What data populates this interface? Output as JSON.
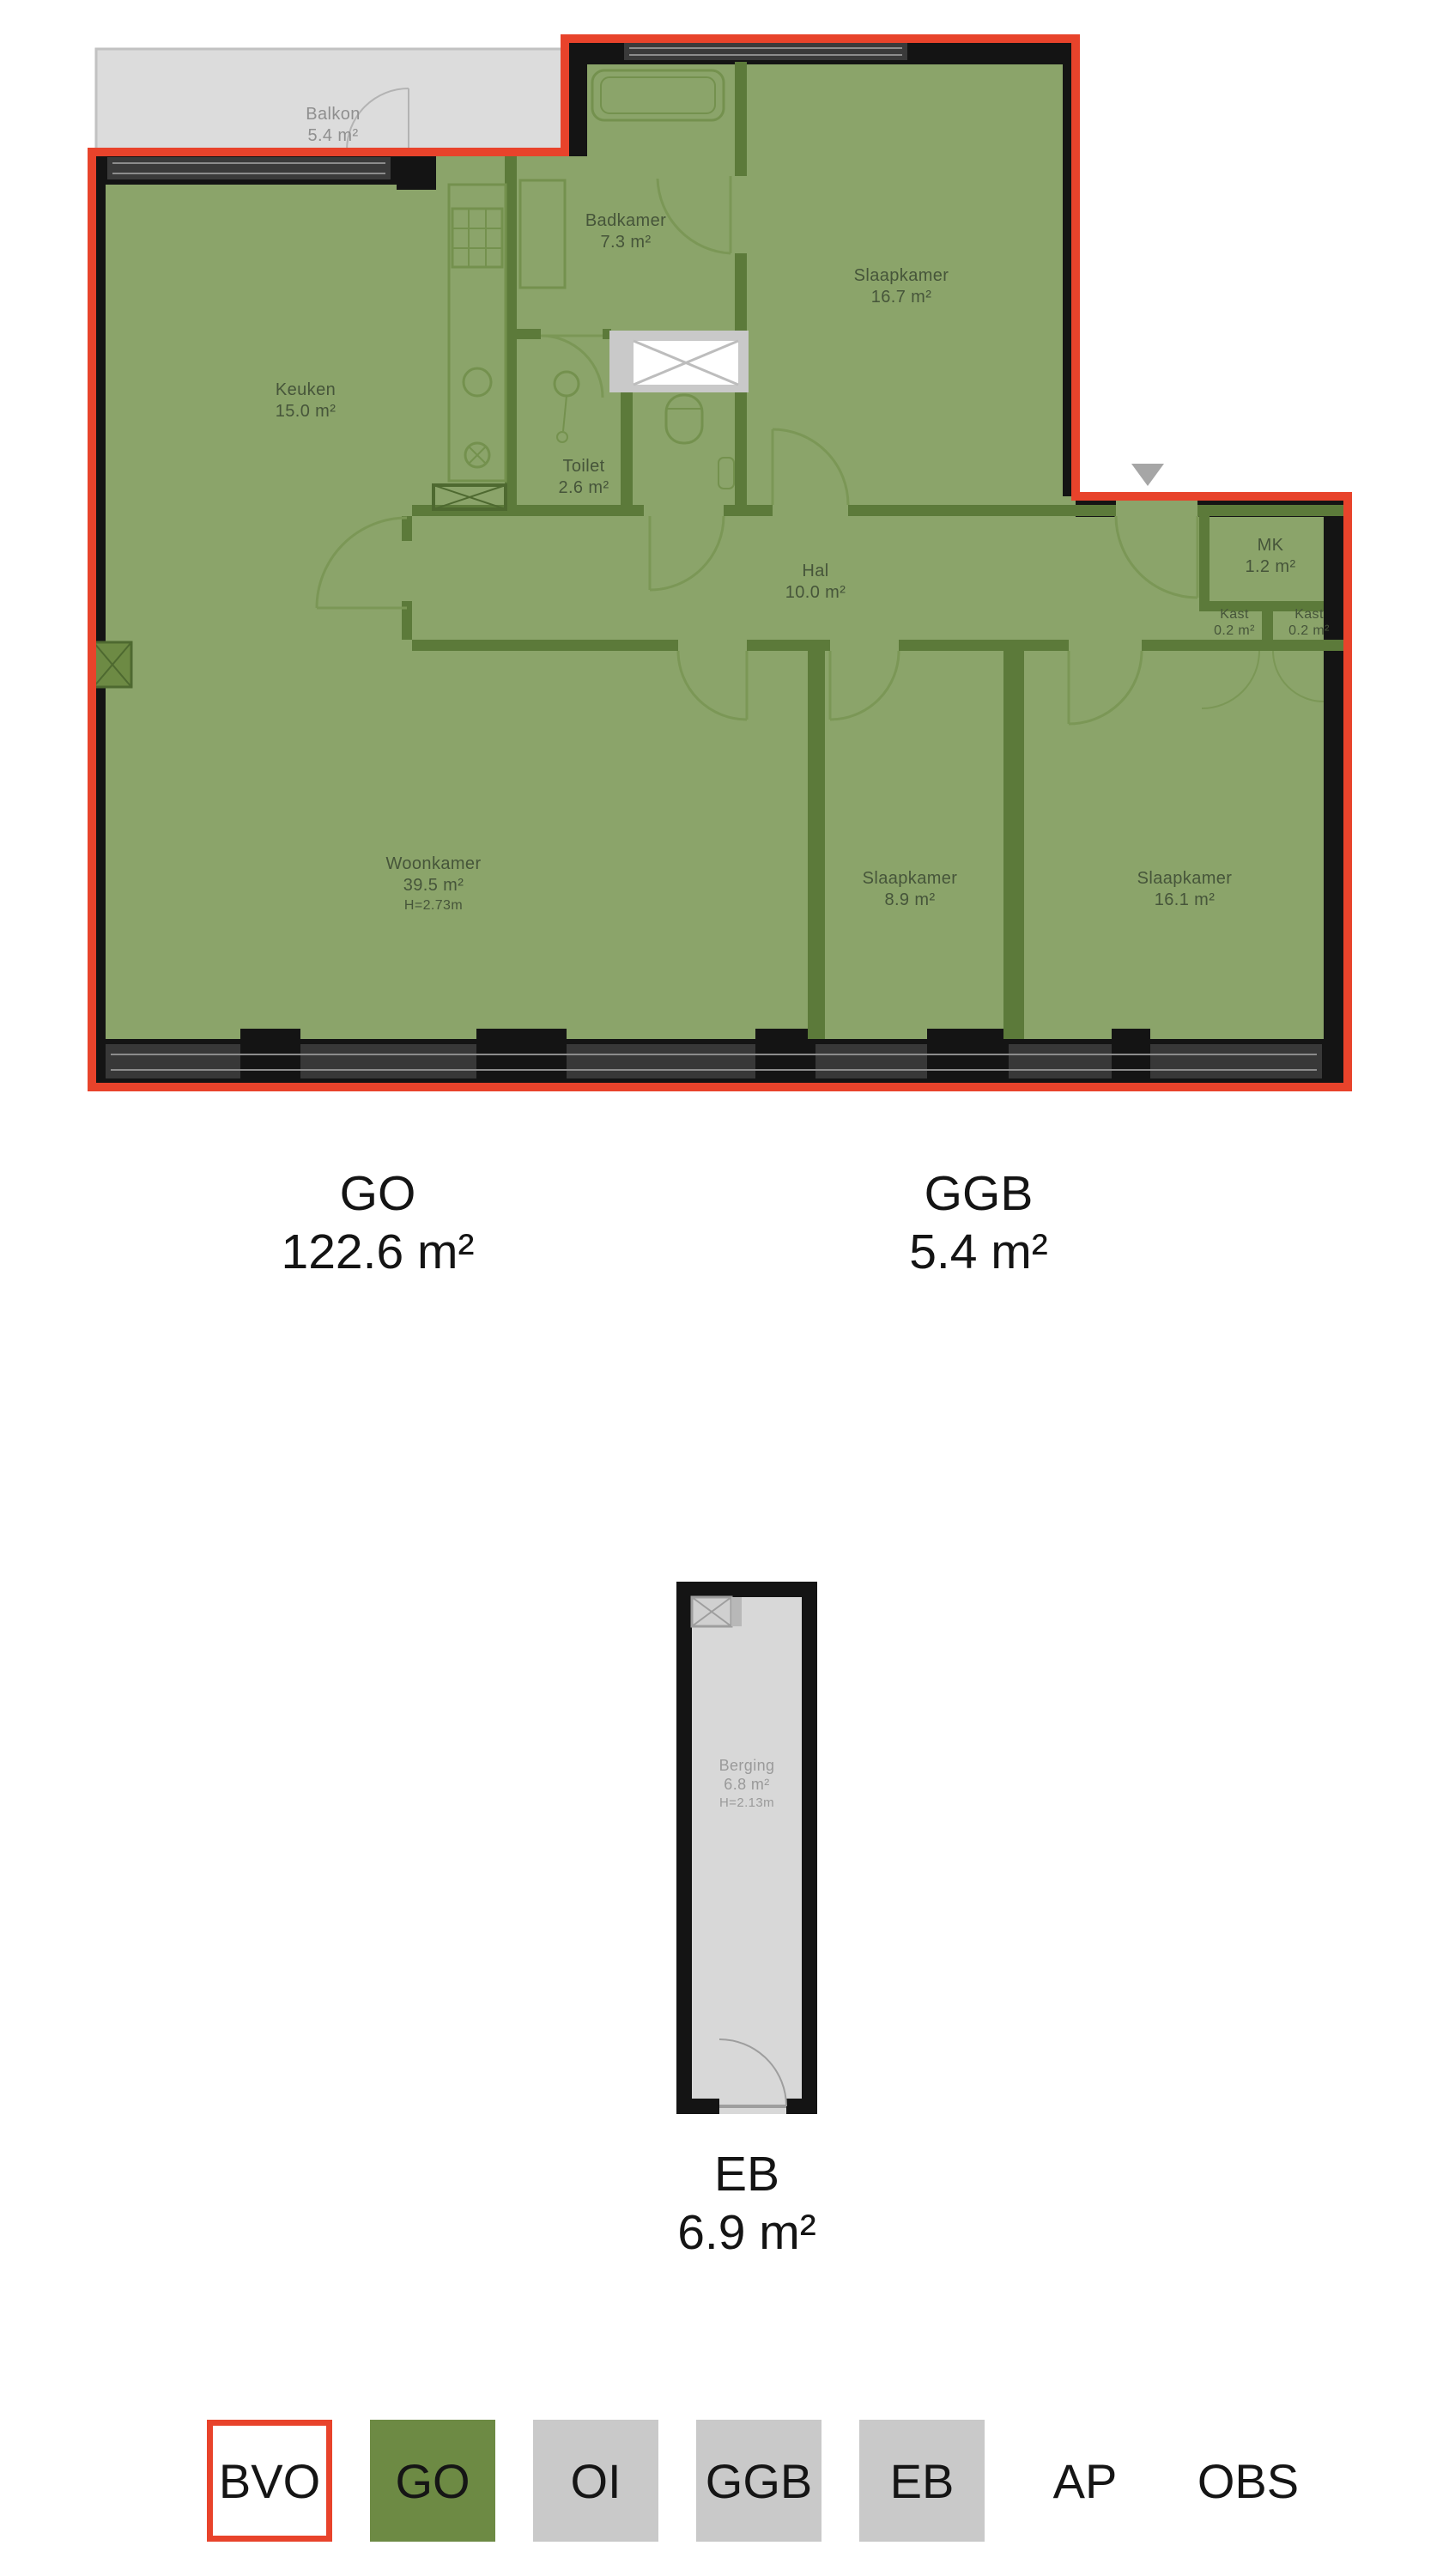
{
  "floorplan": {
    "rooms": [
      {
        "name": "Balkon",
        "area": "5.4 m²"
      },
      {
        "name": "Keuken",
        "area": "15.0 m²"
      },
      {
        "name": "Badkamer",
        "area": "7.3 m²"
      },
      {
        "name": "Slaapkamer",
        "area": "16.7 m²"
      },
      {
        "name": "Toilet",
        "area": "2.6 m²"
      },
      {
        "name": "Hal",
        "area": "10.0 m²"
      },
      {
        "name": "MK",
        "area": "1.2 m²"
      },
      {
        "name": "Kast",
        "area": "0.2 m²"
      },
      {
        "name": "Kast",
        "area": "0.2 m²"
      },
      {
        "name": "Woonkamer",
        "area": "39.5 m²",
        "height": "H=2.73m"
      },
      {
        "name": "Slaapkamer",
        "area": "8.9 m²"
      },
      {
        "name": "Slaapkamer",
        "area": "16.1 m²"
      }
    ],
    "area_labels": [
      {
        "code": "GO",
        "area": "122.6 m²"
      },
      {
        "code": "GGB",
        "area": "5.4 m²"
      }
    ]
  },
  "storage_plan": {
    "rooms": [
      {
        "name": "Berging",
        "area": "6.8 m²",
        "height": "H=2.13m"
      }
    ],
    "area_labels": [
      {
        "code": "EB",
        "area": "6.9 m²"
      }
    ]
  },
  "legend": {
    "items": [
      {
        "label": "BVO",
        "swatch": "outline-red"
      },
      {
        "label": "GO",
        "swatch": "green"
      },
      {
        "label": "OI",
        "swatch": "gray"
      },
      {
        "label": "GGB",
        "swatch": "gray"
      },
      {
        "label": "EB",
        "swatch": "gray"
      },
      {
        "label": "AP",
        "swatch": "none"
      },
      {
        "label": "OBS",
        "swatch": "none"
      }
    ]
  },
  "colors": {
    "bvo_red": "#e8432b",
    "go_green": "#6d8a44",
    "plan_fill": "#8ba46a",
    "wall_green": "#5c7a3a",
    "swatch_gray": "#c9c9c9",
    "outside_gray": "#dcdcdc",
    "wall_black": "#141414"
  },
  "icons": {
    "triangle_marker": "entrance-direction-triangle"
  }
}
